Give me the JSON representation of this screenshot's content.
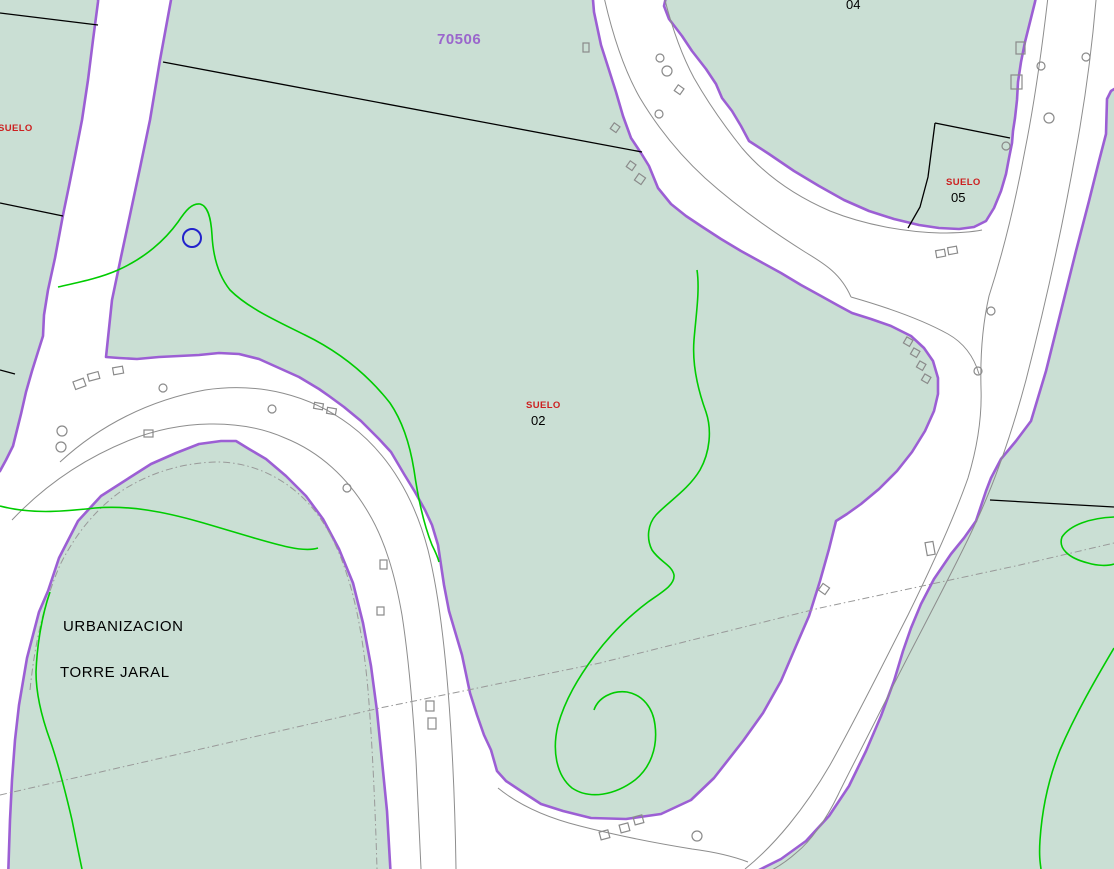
{
  "colors": {
    "background": "#cadfd4",
    "road": "#ffffff",
    "parcel_edge": "#9c5fd4",
    "cadastral_line": "#000000",
    "contour": "#00cc00",
    "road_edge_gray": "#8d8d8d",
    "reference_dash": "#999999",
    "building_marker": "#8a8a8a",
    "selection_blue": "#2222cc",
    "label_red": "#cc2020",
    "label_purple": "#9a66cc",
    "label_black": "#000000"
  },
  "labels": {
    "sector_code": "70506",
    "parcel_04": "04",
    "suelo_left": "SUELO",
    "suelo_05": {
      "title": "SUELO",
      "number": "05"
    },
    "suelo_02": {
      "title": "SUELO",
      "number": "02"
    },
    "urbanization_line1": "URBANIZACION",
    "urbanization_line2": "TORRE JARAL"
  }
}
